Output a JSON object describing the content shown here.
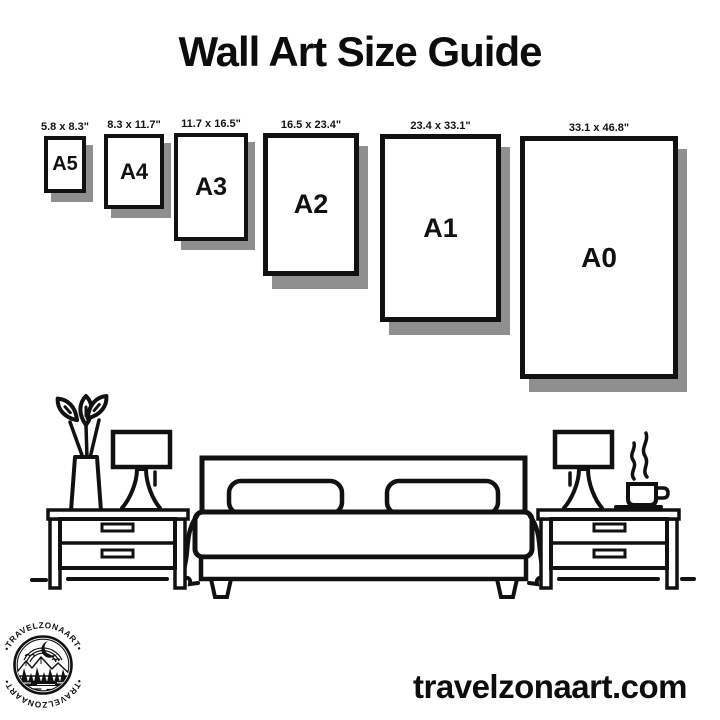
{
  "title": "Wall Art Size Guide",
  "sizes": [
    {
      "name": "A5",
      "dims": "5.8 x 8.3\""
    },
    {
      "name": "A4",
      "dims": "8.3 x 11.7\""
    },
    {
      "name": "A3",
      "dims": "11.7 x 16.5\""
    },
    {
      "name": "A2",
      "dims": "16.5 x 23.4\""
    },
    {
      "name": "A1",
      "dims": "23.4 x 33.1\""
    },
    {
      "name": "A0",
      "dims": "33.1 x 46.8\""
    }
  ],
  "scene": {
    "icons": [
      "flower-vase-icon",
      "table-lamp-icon",
      "nightstand-icon",
      "double-bed-icon",
      "pillow-icon",
      "coffee-cup-icon",
      "steam-icon"
    ]
  },
  "logo": {
    "arc_top": "•TRAVELZONAART•",
    "arc_bottom": "•TRAVELZONAART•"
  },
  "footer": {
    "website": "travelzonaart.com"
  },
  "colors": {
    "ink": "#111111",
    "shadow": "#8f8f8f",
    "background": "#ffffff"
  }
}
